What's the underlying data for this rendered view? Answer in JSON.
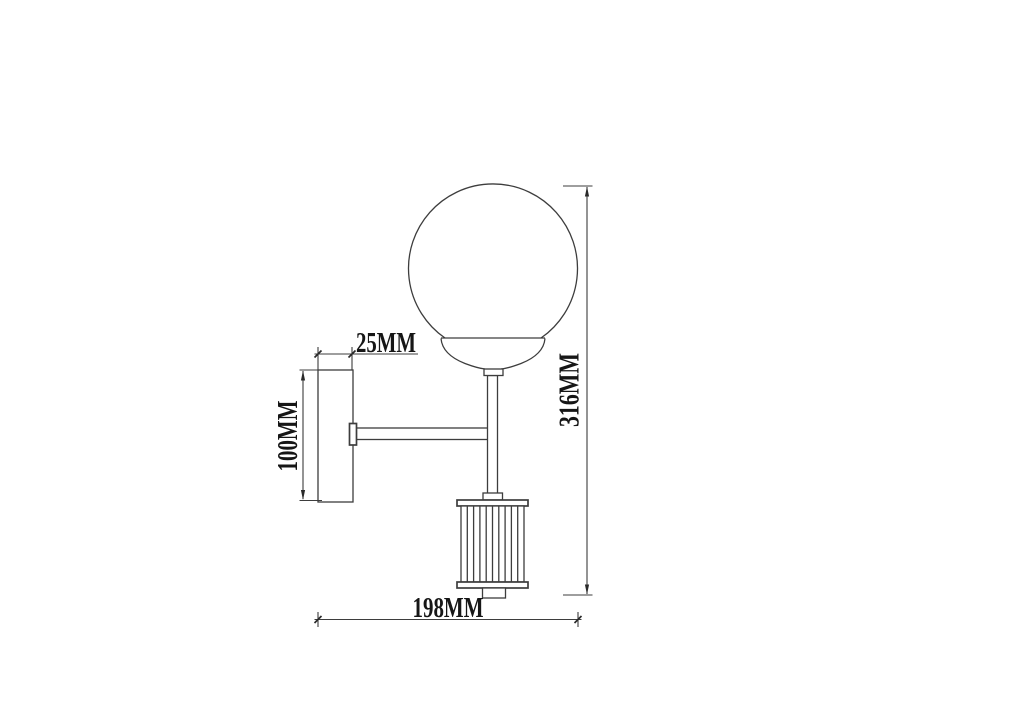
{
  "diagram": {
    "kind": "technical dimension drawing",
    "subject": "wall-mounted sconce lamp with globe shade and ribbed cylinder pendant",
    "background_color": "#ffffff",
    "line_color": "#3d3d3d",
    "text_color": "#161616",
    "labels": {
      "plate_depth": "25MM",
      "plate_height": "100MM",
      "overall_height": "316MM",
      "overall_depth": "198MM"
    }
  }
}
